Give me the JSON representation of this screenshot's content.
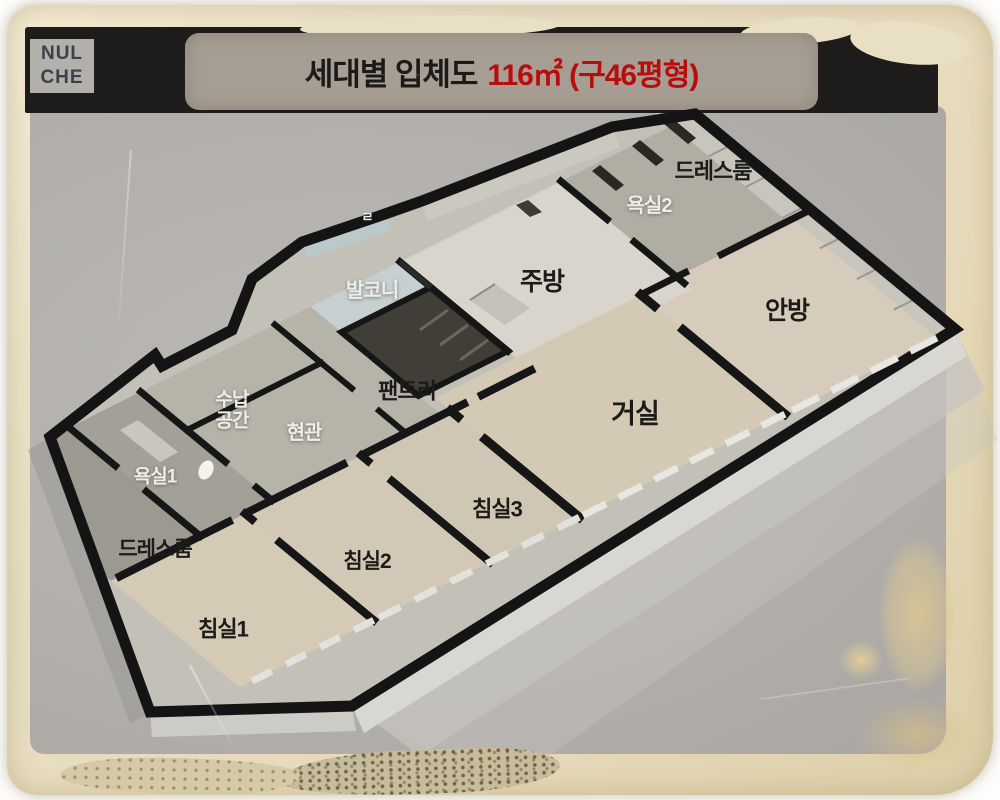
{
  "title": {
    "prefix": "세대별 입체도",
    "highlight": "116㎡ (구46평형)"
  },
  "logo": {
    "text": "NUL\nCHE"
  },
  "rooms": {
    "dressroom_top": "드레스룸",
    "bath2": "욕실2",
    "kitchen": "주방",
    "master_bedroom": "안방",
    "balcony": "발코니",
    "pantry": "팬트리",
    "storage": "수납\n공간",
    "entrance": "현관",
    "living": "거실",
    "bath1": "욕실1",
    "dressroom_left": "드레스룸",
    "bed3": "침실3",
    "bed2": "침실2",
    "bed1": "침실1",
    "partial": "ㄹ"
  },
  "colors": {
    "accent_red": "#b90d0d",
    "title_bar": "#a79e93",
    "paper_beige": "#e9dfc4",
    "concrete_gray": "#b3b0ac",
    "wall_black": "#161616",
    "floor_wood": "#d2c9b6",
    "balcony_blue": "#c6d0d1"
  }
}
